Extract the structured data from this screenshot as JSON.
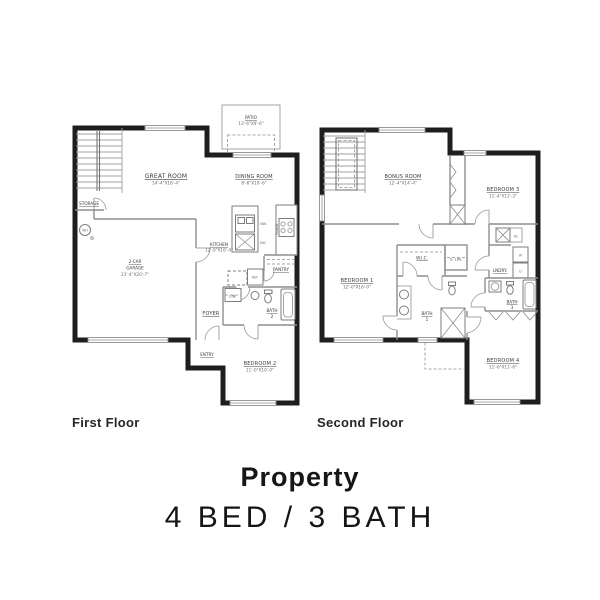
{
  "colors": {
    "background": "#ffffff",
    "exterior_wall": "#1e1e1e",
    "interior_line": "#8e8e8e",
    "room_label": "#3a3a3a",
    "dim_label": "#6a6a6a",
    "title_text": "#161616"
  },
  "floor1": {
    "caption": "First Floor",
    "rooms": {
      "patio": {
        "name": "PATIO",
        "dims": "13'-6\"X9'-6\""
      },
      "great_room": {
        "name": "GREAT ROOM",
        "dims": "14'-4\"X16'-4\""
      },
      "dining_room": {
        "name": "DINING ROOM",
        "dims": "8'-6\"X10'-6\""
      },
      "storage": {
        "name": "STORAGE"
      },
      "kitchen": {
        "name": "KITCHEN",
        "dims": "12'-9\"X16'-4\""
      },
      "pantry": {
        "name": "PANTRY"
      },
      "garage": {
        "line1": "2-CAR",
        "line2": "GARAGE",
        "dims": "23'-4\"X20'-7\""
      },
      "foyer": {
        "name": "FOYER"
      },
      "lin": {
        "name": "LIN."
      },
      "bath2": {
        "line1": "BATH",
        "line2": "2"
      },
      "entry": {
        "name": "ENTRY"
      },
      "bedroom2": {
        "name": "BEDROOM 2",
        "dims": "11'-0\"X10'-0\""
      }
    },
    "fixtures": {
      "water_heater": "WH",
      "sink": "SNK",
      "dishwasher": "DW",
      "range": "RANGE",
      "refrigerator": "REF"
    }
  },
  "floor2": {
    "caption": "Second Floor",
    "rooms": {
      "bonus_room": {
        "name": "BONUS ROOM",
        "dims": "12'-4\"X14'-4\""
      },
      "bedroom3": {
        "name": "BEDROOM 3",
        "dims": "11'-4\"X12'-3\""
      },
      "bedroom1": {
        "name": "BEDROOM 1",
        "dims": "12'-0\"X16'-0\""
      },
      "wic": {
        "name": "W.I.C."
      },
      "slin": {
        "name": "S. LIN."
      },
      "lndry": {
        "name": "LNDRY."
      },
      "bath1": {
        "line1": "BATH",
        "line2": "1"
      },
      "bath3": {
        "line1": "BATH",
        "line2": "3"
      },
      "bedroom4": {
        "name": "BEDROOM 4",
        "dims": "11'-6\"X11'-6\""
      }
    },
    "fixtures": {
      "ac": "AC",
      "washer": "W",
      "dryer": "D"
    }
  },
  "footer": {
    "title": "Property",
    "subtitle": "4 BED / 3 BATH"
  }
}
